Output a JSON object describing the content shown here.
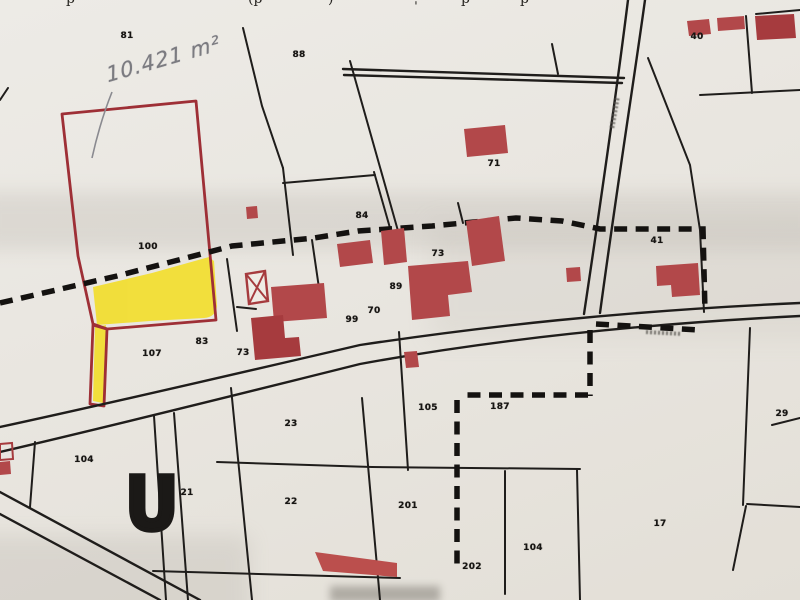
{
  "map": {
    "description": "Scanned cadastral parcel map with highlighted parcel",
    "annotations": {
      "area_text": "10.421 m²",
      "u_mark": "U"
    },
    "top_caption_fragments": [
      {
        "text": "p",
        "x": 66
      },
      {
        "text": "(p",
        "x": 248
      },
      {
        "text": ")",
        "x": 328
      },
      {
        "text": "ˌ",
        "x": 414
      },
      {
        "text": "p",
        "x": 461
      },
      {
        "text": "p",
        "x": 520
      }
    ],
    "parcel_labels": [
      {
        "text": "81",
        "x": 127,
        "y": 36
      },
      {
        "text": "88",
        "x": 299,
        "y": 55
      },
      {
        "text": "40",
        "x": 697,
        "y": 37
      },
      {
        "text": "71",
        "x": 494,
        "y": 164
      },
      {
        "text": "84",
        "x": 362,
        "y": 216
      },
      {
        "text": "100",
        "x": 148,
        "y": 247
      },
      {
        "text": "41",
        "x": 657,
        "y": 241
      },
      {
        "text": "73",
        "x": 438,
        "y": 254
      },
      {
        "text": "89",
        "x": 396,
        "y": 287
      },
      {
        "text": "70",
        "x": 374,
        "y": 311
      },
      {
        "text": "99",
        "x": 352,
        "y": 320
      },
      {
        "text": "107",
        "x": 152,
        "y": 354
      },
      {
        "text": "83",
        "x": 202,
        "y": 342
      },
      {
        "text": "73",
        "x": 243,
        "y": 353
      },
      {
        "text": "23",
        "x": 291,
        "y": 424
      },
      {
        "text": "104",
        "x": 84,
        "y": 460
      },
      {
        "text": "21",
        "x": 187,
        "y": 493
      },
      {
        "text": "22",
        "x": 291,
        "y": 502
      },
      {
        "text": "105",
        "x": 428,
        "y": 408
      },
      {
        "text": "187",
        "x": 500,
        "y": 407
      },
      {
        "text": "201",
        "x": 408,
        "y": 506
      },
      {
        "text": "202",
        "x": 472,
        "y": 567
      },
      {
        "text": "104",
        "x": 533,
        "y": 548
      },
      {
        "text": "17",
        "x": 660,
        "y": 524
      },
      {
        "text": "29",
        "x": 782,
        "y": 414
      }
    ],
    "colors": {
      "parcel_outline_red": "#9e2f36",
      "building_fill_red": "#b2484a",
      "highlight_yellow": "#f2de2e",
      "boundary_black": "#1f1d1b",
      "pencil_gray": "#7b7b80",
      "paper": "#eae7e1"
    }
  }
}
